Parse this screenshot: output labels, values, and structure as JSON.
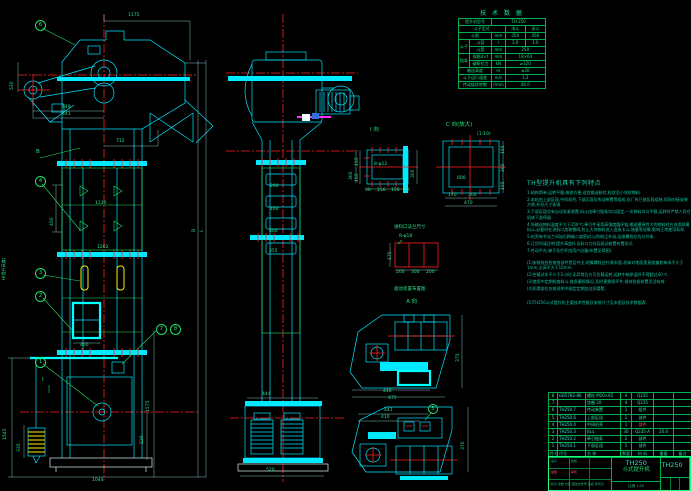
{
  "drawing": {
    "model": "TH250",
    "product_name": "斗式提升机"
  },
  "colors": {
    "line_cyan": "#00e5ff",
    "centerline_red": "#ff2222",
    "dim_green": "#2de08a",
    "table_green": "#19ff80",
    "bucket_yellow": "#ffee00",
    "accent_magenta": "#ff30ff"
  },
  "tech_table": {
    "title": "技 术 数 据",
    "rows": {
      "r1l": "提升机型号",
      "r1v": "TH 250",
      "r2l": "斗子型式",
      "r2a": "浅斗",
      "r2b": "深斗",
      "r3l": "斗距",
      "r3u": "mm",
      "r3a": "350",
      "r3b": "450",
      "grp1": "斗子",
      "r4l": "斗容",
      "r4u": "l",
      "r4a": "3.0",
      "r4b": "1.6",
      "r5l": "斗宽",
      "r5u": "mm",
      "r5v": "250",
      "grp2": "链条",
      "r6l": "规格d×t",
      "r6u": "mm",
      "r6v": "18×64",
      "r7l": "破断拉力",
      "r7u": "kN",
      "r7v": "≥320",
      "r8l": "输送高度",
      "r8u": "m",
      "r8v": "≤30",
      "r9l": "斗子运行速度",
      "r9u": "m/s",
      "r9v": "1.2",
      "r10l": "传动链轮转数",
      "r10u": "r/min",
      "r10v": "46.0"
    }
  },
  "notes": {
    "title": "TH型提升机具有下列特点",
    "lines": [
      "1.结构简单,运转平稳,维修方便,适宜输送粉状,粒状及小块状物料.",
      "2.本机由上部区段,中间机壳,下部区段及传动装置等组成,出厂时已按区段组装,现场对接安装方便,外形尺寸紧凑.",
      "3.下部区段设有自动张紧装置,料斗由牵引链条均匀固定,一次装料均匀平稳,运转时严禁人员在机体下部停留.",
      "4.所输送物料温度不大于250℃,牵引件采用高强度圆环链,输送磨琢性大的物料时应选用耐磨料斗,必要时在进料口加装篦网,防止大块物料进入造成卡斗,堵塞等现象,影响正常使用寿命.",
      "5.机壳每节法兰间加石棉绳二道密封,以防粉尘外溢,连接螺栓应均匀拧紧.",
      "6.订货时请注明:提升高度H,出料口方向及驱动装置布置形式.",
      "7.传动平台,梯子及栏杆由用户自备(布置见简图).",
      "(1)安装前应检查各部件是否齐全,地脚螺栓应拧紧牢固,机体对地面垂直度偏差每米不大于1mm,全高不大于10mm.",
      "(2)空载试车不少于2小时,无异常后方可负载运转,运转中轴承温升不得超过40℃.",
      "(3)使用中定期检查料斗,链条磨损情况,及时更换损坏件,保持张紧装置灵活有效.",
      "(4)润滑部位应按说明书规定定期加注润滑脂.",
      "(5)TH250斗式提升机主要技术性能及安装尺寸见本图及技术数据表."
    ]
  },
  "bom": {
    "headers": [
      "件号",
      "代号",
      "名 称",
      "数量",
      "材 料",
      "重量",
      "备注"
    ],
    "rows": [
      [
        "8",
        "GB5782-86",
        "螺栓 M20×85",
        "4",
        "Q235",
        "",
        ""
      ],
      [
        "7",
        "",
        "垫圈 20",
        "4",
        "Q235",
        "",
        ""
      ],
      [
        "6",
        "TH250.7",
        "传动装置",
        "1",
        "组件",
        "",
        ""
      ],
      [
        "5",
        "TH250.6",
        "上部区段",
        "1",
        "部件",
        "",
        ""
      ],
      [
        "4",
        "TH250.4",
        "中间机壳",
        "1",
        "部件",
        "",
        ""
      ],
      [
        "3",
        "TH250.3",
        "料斗",
        "30",
        "Q235-A",
        "20.4",
        ""
      ],
      [
        "2",
        "TH250.2",
        "牵引链条",
        "2",
        "部件",
        "",
        ""
      ],
      [
        "1",
        "TH250.1",
        "下部区段",
        "1",
        "部件",
        "",
        ""
      ]
    ]
  },
  "title_block": {
    "model": "TH250",
    "name": "斗式提升机",
    "dwg_no": "TH250",
    "rev_row": "标记 处数 分区 更改文件号 签名 年月日",
    "sign1": "设计",
    "sign2": "校核",
    "sign3": "描图",
    "sign4": "审核",
    "scale_label": "比例",
    "scale": "1:25"
  },
  "front_view": {
    "balloons": {
      "b1": "1",
      "b2": "2",
      "b3": "3",
      "b4": "4",
      "b6": "6",
      "b7": "7",
      "b8": "8"
    },
    "marker_b": "B",
    "marker_i": "I",
    "dims": {
      "top": "1175",
      "mid": "712",
      "v450": "450",
      "c1130": "1130",
      "c1202": "1202",
      "door": "400",
      "base": "1044",
      "left1545": "1545",
      "w335": "335",
      "r1575": "1575",
      "r520": "520",
      "tension": "520",
      "a449": "449",
      "a441": "441",
      "height_label": "H(提升高度)",
      "letterB": "B",
      "letterL": "L"
    }
  },
  "side_view": {
    "dims": {
      "d200": "200",
      "d160": "160",
      "d400": "400",
      "d355": "355",
      "top444": "444",
      "base520": "520",
      "r300": "300"
    }
  },
  "sections": {
    "s1": {
      "label": "I 向",
      "bolt": "8-φ12",
      "l155a": "155",
      "l155b": "155",
      "r300": "300",
      "b90": "90",
      "b156a": "156",
      "b156b": "156",
      "b92": "92"
    },
    "s2": {
      "label": "C 向(放大)",
      "scale": "(1:10)",
      "in600": "600",
      "b170": "170",
      "b300": "300",
      "t470": "470",
      "r155a": "155",
      "r300": "300",
      "r155b": "155"
    },
    "inlet_label": "进料口法兰尺寸",
    "red_detail": {
      "bolt": "8-φ18",
      "left": "170",
      "b1": "200",
      "b2": "300",
      "b3": "200"
    },
    "aview": {
      "caption": "驱动装置布置图",
      "label": "A 向",
      "balloon5": "5",
      "d1r": "375",
      "d1b1": "440",
      "d1b2": "475",
      "d2t1": "441",
      "d2t2": "410",
      "d2r": "370"
    }
  }
}
